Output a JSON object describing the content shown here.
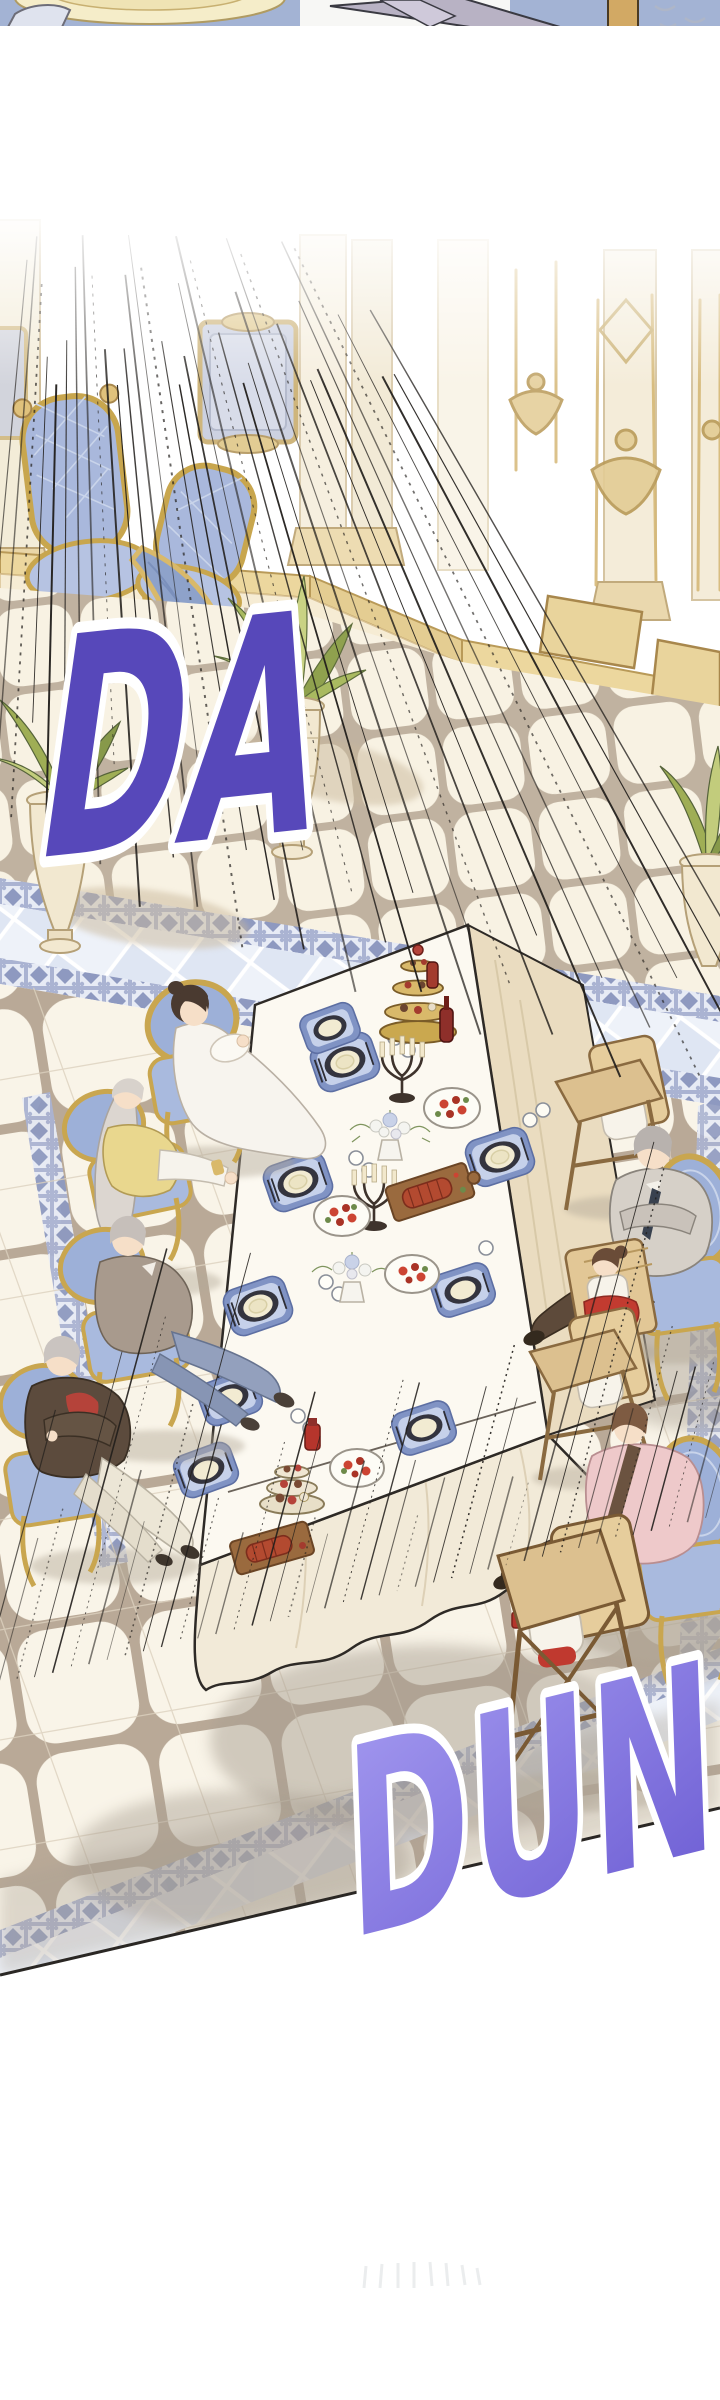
{
  "sfx": {
    "da": {
      "text": "DA",
      "fill": "#5748ba",
      "outline": "#ffffff"
    },
    "dun": {
      "text": "DUN",
      "fill_top": "#a49af0",
      "fill_bottom": "#7263d6",
      "outline": "#ffffff"
    }
  },
  "palette": {
    "speed_lines": "#211e1b",
    "panel_divider": "#1c1c1c",
    "chair_gold": "#c9a64f",
    "upholstery_blue": "#9db0d8",
    "floor_cream": "#f9f4e8",
    "tile_gap_taupe": "#b9a997",
    "border_band_blue": "#8e99c0",
    "pale_tile_blue": "#dfe6f3",
    "table_white": "#fcf9f1",
    "cloth_tan": "#eadcc0",
    "shadow_taupe": "#a89f92",
    "highchair_wood": "#dcc08f",
    "plant_green": "#a9ba60",
    "meat_red": "#b34a30",
    "salad_red": "#cc4433"
  }
}
